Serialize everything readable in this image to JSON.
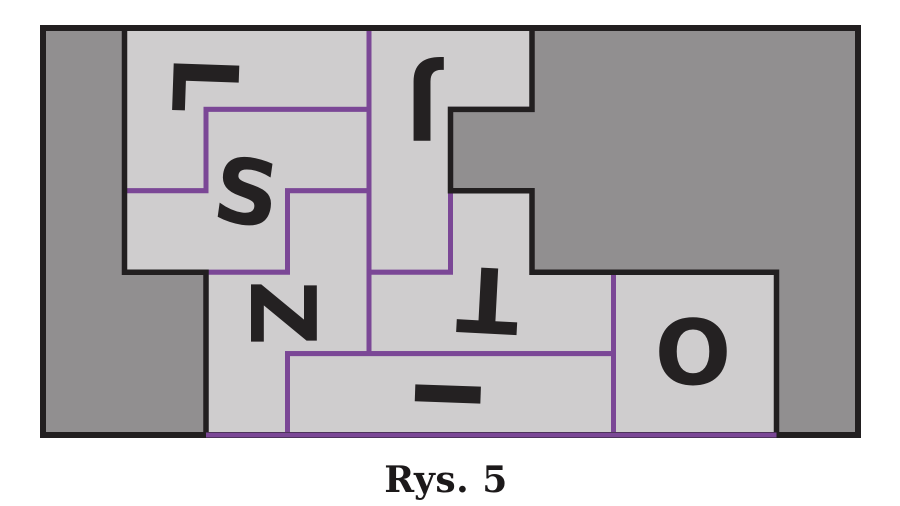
{
  "figure": {
    "type": "tetromino-packing-diagram",
    "caption": "Rys. 5",
    "colors": {
      "page_bg": "#ffffff",
      "uncovered_fill": "#918f90",
      "piece_fill": "#cfcdce",
      "piece_outline": "#7b4796",
      "border": "#221f20",
      "letter": "#242122"
    },
    "grid": {
      "x0": 43,
      "y0": 28,
      "cell_w": 81.5,
      "cell_h": 81.4,
      "cols": 10,
      "rows": 5
    },
    "stroke": {
      "piece": 5,
      "region": 5.5,
      "outer": 6
    },
    "letter_font_size": 90,
    "pieces": [
      {
        "name": "l",
        "letter": "L",
        "points": [
          [
            1,
            0
          ],
          [
            4,
            0
          ],
          [
            4,
            1
          ],
          [
            2,
            1
          ],
          [
            2,
            2
          ],
          [
            1,
            2
          ]
        ],
        "label_x": 206,
        "label_y": 85,
        "label_rot": 92
      },
      {
        "name": "j",
        "letter": "J",
        "points": [
          [
            4,
            0
          ],
          [
            6,
            0
          ],
          [
            6,
            1
          ],
          [
            5,
            1
          ],
          [
            5,
            3
          ],
          [
            4,
            3
          ]
        ],
        "label_x": 422,
        "label_y": 108,
        "label_rot": 180
      },
      {
        "name": "s",
        "letter": "S",
        "points": [
          [
            2,
            1
          ],
          [
            4,
            1
          ],
          [
            4,
            2
          ],
          [
            3,
            2
          ],
          [
            3,
            3
          ],
          [
            1,
            3
          ],
          [
            1,
            2
          ],
          [
            2,
            2
          ]
        ],
        "label_x": 247,
        "label_y": 191,
        "label_rot": 8
      },
      {
        "name": "z",
        "letter": "Z",
        "points": [
          [
            3,
            2
          ],
          [
            4,
            2
          ],
          [
            4,
            4
          ],
          [
            3,
            4
          ],
          [
            3,
            5
          ],
          [
            2,
            5
          ],
          [
            2,
            3
          ],
          [
            3,
            3
          ]
        ],
        "label_x": 284,
        "label_y": 313,
        "label_rot": 90
      },
      {
        "name": "t",
        "letter": "T",
        "points": [
          [
            5,
            2
          ],
          [
            6,
            2
          ],
          [
            6,
            3
          ],
          [
            7,
            3
          ],
          [
            7,
            4
          ],
          [
            4,
            4
          ],
          [
            4,
            3
          ],
          [
            5,
            3
          ]
        ],
        "label_x": 488,
        "label_y": 301,
        "label_rot": 183
      },
      {
        "name": "i",
        "letter": "I",
        "points": [
          [
            3,
            4
          ],
          [
            7,
            4
          ],
          [
            7,
            5
          ],
          [
            3,
            5
          ]
        ],
        "label_x": 448,
        "label_y": 394,
        "label_rot": 92
      },
      {
        "name": "o",
        "letter": "O",
        "points": [
          [
            7,
            3
          ],
          [
            9,
            3
          ],
          [
            9,
            5
          ],
          [
            7,
            5
          ]
        ],
        "label_x": 693,
        "label_y": 351,
        "label_rot": 0
      }
    ],
    "uncovered_regions": [
      {
        "name": "left",
        "points": [
          [
            0,
            0
          ],
          [
            1,
            0
          ],
          [
            1,
            3
          ],
          [
            2,
            3
          ],
          [
            2,
            5
          ],
          [
            0,
            5
          ]
        ]
      },
      {
        "name": "right",
        "points": [
          [
            6,
            0
          ],
          [
            10,
            0
          ],
          [
            10,
            5
          ],
          [
            9,
            5
          ],
          [
            9,
            3
          ],
          [
            6,
            3
          ],
          [
            6,
            2
          ],
          [
            5,
            2
          ],
          [
            5,
            1
          ],
          [
            6,
            1
          ]
        ]
      }
    ],
    "bottom_edge_purple": {
      "from_col": 2,
      "to_col": 9
    }
  }
}
